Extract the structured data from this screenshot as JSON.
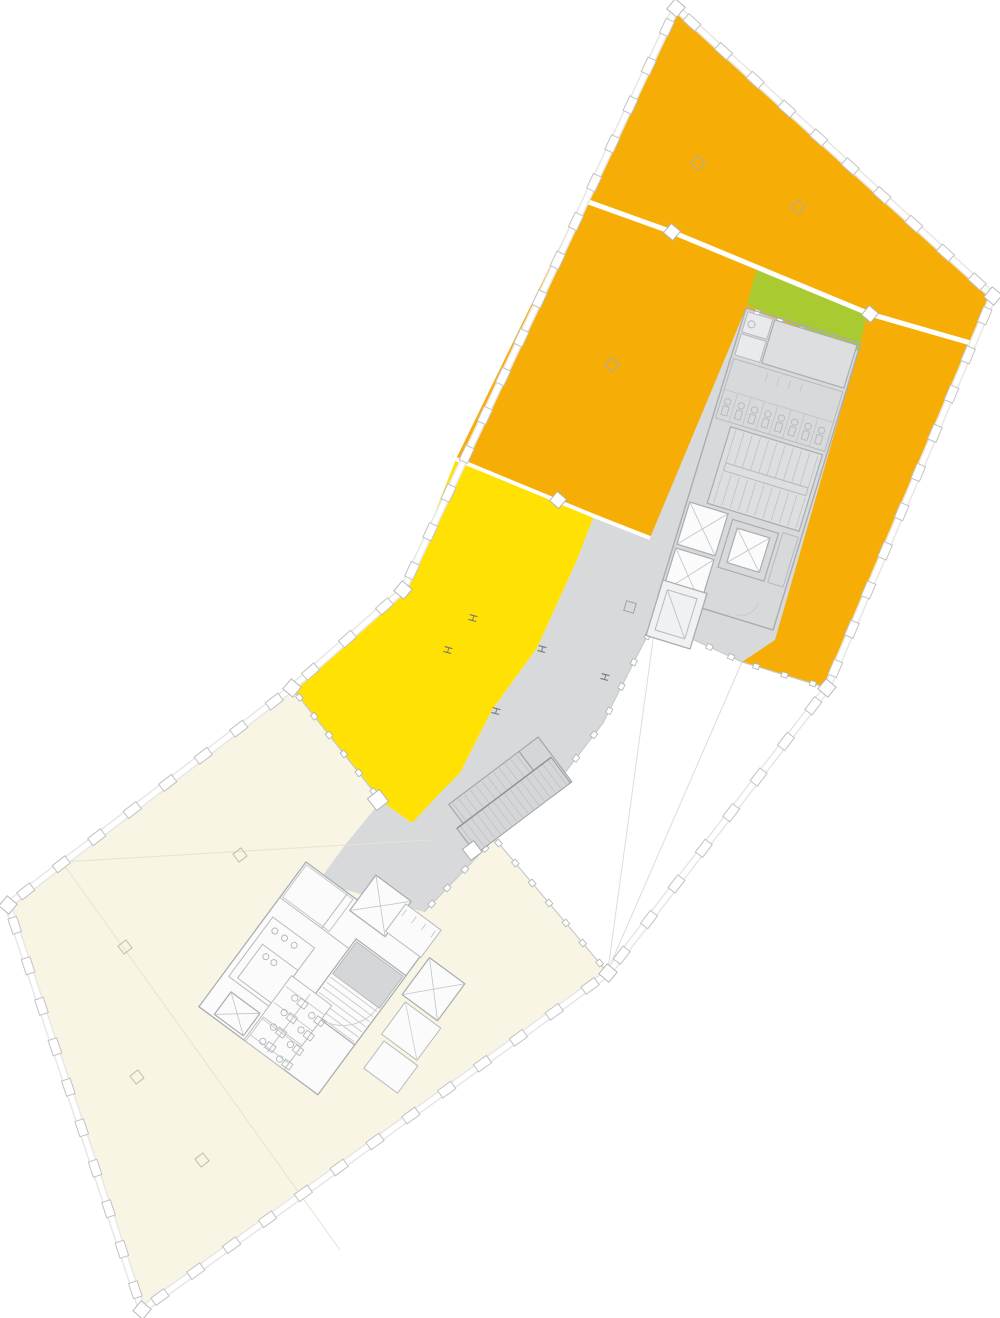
{
  "canvas": {
    "w": 1000,
    "h": 1318,
    "bg": "#ffffff"
  },
  "palette": {
    "orange": "#F6AE07",
    "yellow": "#FFE103",
    "green": "#AACA31",
    "gray": "#D8D9DB",
    "gray_dark": "#D2D4D6",
    "room": "#FBFBFB",
    "wall": "#A9ADB0",
    "wall_light": "#B7BABC",
    "detail": "#C3C6C8",
    "facade_stroke": "#C2C2C2",
    "facade_band": "#E7E7E7",
    "white": "#FFFFFF",
    "void_line": "#DCDCDC",
    "cream_line": "#E7E3D2",
    "cream": "#F8F5E4",
    "marker_gray": "#ABABAB",
    "marker_cream": "#C2BDA4",
    "h_color": "#787878"
  },
  "zones": [
    {
      "name": "zone-lower-cream-wing",
      "fill": "cream",
      "points": [
        [
          292,
          688
        ],
        [
          381,
          801
        ],
        [
          490,
          833
        ],
        [
          608,
          973
        ],
        [
          142,
          1310
        ],
        [
          8,
          905
        ]
      ]
    },
    {
      "name": "zone-upper-orange",
      "fill": "orange",
      "points": [
        [
          676,
          8
        ],
        [
          993,
          296
        ],
        [
          827,
          688
        ],
        [
          742,
          662
        ],
        [
          655,
          622
        ],
        [
          594,
          516
        ],
        [
          456,
          459
        ]
      ]
    },
    {
      "name": "zone-yellow",
      "fill": "yellow",
      "points": [
        [
          456,
          459
        ],
        [
          594,
          516
        ],
        [
          577,
          560
        ],
        [
          537,
          648
        ],
        [
          492,
          710
        ],
        [
          460,
          773
        ],
        [
          412,
          823
        ],
        [
          381,
          801
        ],
        [
          292,
          688
        ],
        [
          403,
          590
        ],
        [
          417,
          563
        ],
        [
          432,
          520
        ]
      ]
    },
    {
      "name": "zone-core-plaza-gray",
      "fill": "gray",
      "points": [
        [
          746,
          308
        ],
        [
          858,
          351
        ],
        [
          775,
          640
        ],
        [
          742,
          662
        ],
        [
          655,
          622
        ],
        [
          640,
          650
        ],
        [
          603,
          723
        ],
        [
          567,
          770
        ],
        [
          540,
          798
        ],
        [
          495,
          838
        ],
        [
          455,
          880
        ],
        [
          424,
          912
        ],
        [
          318,
          882
        ],
        [
          345,
          845
        ],
        [
          381,
          801
        ],
        [
          412,
          823
        ],
        [
          440,
          793
        ],
        [
          460,
          773
        ],
        [
          492,
          710
        ],
        [
          537,
          648
        ],
        [
          577,
          560
        ],
        [
          594,
          516
        ],
        [
          650,
          538
        ]
      ]
    },
    {
      "name": "zone-green",
      "fill": "green",
      "points": [
        [
          757,
          267
        ],
        [
          868,
          313
        ],
        [
          858,
          351
        ],
        [
          747,
          305
        ]
      ]
    }
  ],
  "faint_lines": [
    {
      "name": "void-sight-line-1",
      "points": [
        [
          655,
          625
        ],
        [
          608,
          970
        ]
      ],
      "color": "#DCDCDC"
    },
    {
      "name": "void-sight-line-2",
      "points": [
        [
          742,
          662
        ],
        [
          608,
          970
        ]
      ],
      "color": "#DCDCDC"
    },
    {
      "name": "void-sight-line-3",
      "points": [
        [
          827,
          690
        ],
        [
          610,
          968
        ]
      ],
      "color": "#E2E2E2"
    },
    {
      "name": "cream-partition-line-1",
      "points": [
        [
          62,
          862
        ],
        [
          340,
          1250
        ]
      ],
      "color": "#E7E3D2"
    },
    {
      "name": "cream-partition-line-2",
      "points": [
        [
          62,
          862
        ],
        [
          430,
          840
        ]
      ],
      "color": "#E7E3D2"
    }
  ],
  "facade": {
    "spacing": 44,
    "tick_w": 16,
    "tick_h": 9,
    "segments": [
      [
        [
          676,
          8
        ],
        [
          993,
          296
        ]
      ],
      [
        [
          993,
          296
        ],
        [
          827,
          688
        ]
      ],
      [
        [
          827,
          688
        ],
        [
          608,
          973
        ]
      ],
      [
        [
          608,
          973
        ],
        [
          142,
          1310
        ]
      ],
      [
        [
          142,
          1310
        ],
        [
          8,
          905
        ]
      ],
      [
        [
          8,
          905
        ],
        [
          292,
          688
        ]
      ],
      [
        [
          292,
          688
        ],
        [
          403,
          590
        ]
      ],
      [
        [
          403,
          590
        ],
        [
          676,
          8
        ]
      ]
    ],
    "corners": [
      [
        676,
        8
      ],
      [
        993,
        296
      ],
      [
        827,
        688
      ],
      [
        608,
        973
      ],
      [
        142,
        1310
      ],
      [
        8,
        905
      ],
      [
        292,
        688
      ],
      [
        403,
        590
      ]
    ]
  },
  "tick_lines": [
    {
      "name": "glass-yellow-cream",
      "points": [
        [
          292,
          688
        ],
        [
          381,
          801
        ]
      ]
    },
    {
      "name": "glass-plaza-void-a",
      "points": [
        [
          655,
          622
        ],
        [
          742,
          662
        ]
      ]
    },
    {
      "name": "glass-orange-void",
      "points": [
        [
          742,
          662
        ],
        [
          827,
          688
        ]
      ]
    },
    {
      "name": "glass-corridor-edge",
      "points": [
        [
          655,
          622
        ],
        [
          640,
          650
        ],
        [
          603,
          723
        ],
        [
          567,
          770
        ],
        [
          540,
          798
        ],
        [
          495,
          838
        ],
        [
          455,
          880
        ],
        [
          424,
          912
        ]
      ]
    },
    {
      "name": "glass-cream-void",
      "points": [
        [
          490,
          833
        ],
        [
          608,
          973
        ]
      ]
    },
    {
      "name": "glass-core-top",
      "points": [
        [
          746,
          308
        ],
        [
          858,
          351
        ]
      ]
    }
  ],
  "joints": {
    "lines": [
      {
        "name": "floor-joint-upper",
        "points": [
          [
            558,
            191
          ],
          [
            672,
            232
          ],
          [
            870,
            314
          ],
          [
            974,
            344
          ]
        ],
        "w": 5
      },
      {
        "name": "floor-joint-lower",
        "points": [
          [
            456,
            459
          ],
          [
            594,
            516
          ],
          [
            650,
            538
          ]
        ],
        "w": 4
      }
    ],
    "squares": [
      {
        "x": 672,
        "y": 232,
        "s": 12,
        "r": 40
      },
      {
        "x": 870,
        "y": 314,
        "s": 12,
        "r": 40
      },
      {
        "x": 558,
        "y": 500,
        "s": 12,
        "r": 40
      },
      {
        "x": 378,
        "y": 800,
        "s": 15,
        "r": 52
      }
    ]
  },
  "markers": {
    "h_glyph": "H",
    "h_columns": [
      [
        469,
        617
      ],
      [
        444,
        649
      ],
      [
        538,
        648
      ],
      [
        601,
        676
      ],
      [
        492,
        710
      ]
    ],
    "squares_orange": [
      [
        698,
        163
      ],
      [
        798,
        207
      ],
      [
        612,
        365
      ]
    ],
    "squares_plaza": [
      [
        630,
        607
      ]
    ],
    "diamonds_cream": [
      [
        240,
        855
      ],
      [
        125,
        947
      ],
      [
        137,
        1077
      ],
      [
        202,
        1160
      ]
    ]
  },
  "groups": [
    {
      "name": "upper-core",
      "transform": "translate(746,308) rotate(17)",
      "prims": [
        {
          "t": "rect",
          "x": 0,
          "y": 0,
          "w": 120,
          "h": 300,
          "s": "#A9ADB0",
          "sw": 1.4
        },
        {
          "t": "rect",
          "x": 3,
          "y": 3,
          "w": 26,
          "h": 21,
          "f": "#E9EAEB",
          "s": "#B7BABC"
        },
        {
          "t": "rect",
          "x": 3,
          "y": 26,
          "w": 26,
          "h": 22,
          "f": "#E9EAEB",
          "s": "#B7BABC"
        },
        {
          "t": "circle",
          "cx": 10,
          "cy": 14,
          "r": 3.5,
          "s": "#B7BABC"
        },
        {
          "t": "rect",
          "x": 31,
          "y": 3,
          "w": 86,
          "h": 45,
          "f": "#DCDEE0",
          "s": "#A9ADB0",
          "sw": 1.2
        },
        {
          "t": "rect",
          "x": 3,
          "y": 52,
          "w": 114,
          "h": 62,
          "s": "#B7BABC"
        },
        {
          "t": "line",
          "x1": 3,
          "y1": 84,
          "x2": 117,
          "y2": 84,
          "s": "#C3C6C8"
        },
        {
          "t": "grill",
          "x": 17,
          "y": 84,
          "w": 84,
          "h": 30,
          "n": 7,
          "o": "v"
        },
        {
          "t": "wcrow",
          "x": 10,
          "y": 95,
          "dx": 14,
          "n": 8
        },
        {
          "t": "grill",
          "x": 40,
          "y": 56,
          "w": 36,
          "h": 9,
          "n": 4,
          "o": "v"
        },
        {
          "t": "rect",
          "x": 20,
          "y": 118,
          "w": 96,
          "h": 80,
          "f": "#DCDEE0",
          "s": "#A9ADB0",
          "sw": 1.2
        },
        {
          "t": "grill",
          "x": 26,
          "y": 120,
          "w": 86,
          "h": 34,
          "n": 11,
          "o": "v"
        },
        {
          "t": "grill",
          "x": 26,
          "y": 164,
          "w": 86,
          "h": 32,
          "n": 11,
          "o": "v"
        },
        {
          "t": "rect",
          "x": 26,
          "y": 154,
          "w": 86,
          "h": 8,
          "s": "#B7BABC"
        },
        {
          "t": "xbox",
          "x": 3,
          "y": 202,
          "w": 40,
          "h": 44
        },
        {
          "t": "xbox",
          "x": 3,
          "y": 250,
          "w": 40,
          "h": 46
        },
        {
          "t": "rect",
          "x": 49,
          "y": 206,
          "w": 48,
          "h": 50,
          "s": "#A9ADB0",
          "sw": 1.2
        },
        {
          "t": "xbox",
          "x": 56,
          "y": 213,
          "w": 34,
          "h": 36
        },
        {
          "t": "rect",
          "x": 101,
          "y": 204,
          "w": 16,
          "h": 52,
          "s": "#B7BABC"
        },
        {
          "t": "arc",
          "d": "M 98 278 a 18 18 0 0 1 -18 18",
          "s": "#C9C9C9"
        }
      ]
    },
    {
      "name": "plaza-shaft",
      "transform": "translate(663,580) rotate(17)",
      "prims": [
        {
          "t": "rect",
          "x": 0,
          "y": 0,
          "w": 46,
          "h": 58,
          "f": "#F0F1F2",
          "s": "#A9ADB0",
          "sw": 1.3
        },
        {
          "t": "rect",
          "x": 7,
          "y": 8,
          "w": 31,
          "h": 42,
          "s": "#B7BABC"
        },
        {
          "t": "line",
          "x1": 7,
          "y1": 8,
          "x2": 38,
          "y2": 50,
          "s": "#C3C6C8"
        }
      ]
    },
    {
      "name": "corridor-stair",
      "transform": "translate(452,822) rotate(-37)",
      "prims": [
        {
          "t": "rect",
          "x": 96,
          "y": -16,
          "w": 24,
          "h": 56,
          "f": "#D4D6D8",
          "s": "#9AA0A4"
        },
        {
          "t": "rect",
          "x": 0,
          "y": 8,
          "w": 118,
          "h": 32,
          "f": "#D4D6D8",
          "s": "#9AA0A4"
        },
        {
          "t": "grill",
          "x": 4,
          "y": 8,
          "w": 110,
          "h": 32,
          "n": 17,
          "o": "v"
        },
        {
          "t": "rect",
          "x": 8,
          "y": -16,
          "w": 88,
          "h": 24,
          "f": "#D4D6D8",
          "s": "#9AA0A4"
        },
        {
          "t": "grill",
          "x": 12,
          "y": -16,
          "w": 80,
          "h": 24,
          "n": 12,
          "o": "v"
        },
        {
          "t": "line",
          "x1": 0,
          "y1": 8,
          "x2": 118,
          "y2": 8,
          "s": "#8D9296",
          "sw": 1.4
        },
        {
          "t": "rect",
          "x": -8,
          "y": 28,
          "w": 14,
          "h": 14,
          "f": "#FFFFFF",
          "s": "#A9ADB0"
        }
      ]
    },
    {
      "name": "lower-core",
      "transform": "translate(306,862) rotate(36.5)",
      "prims": [
        {
          "t": "rect",
          "x": 0,
          "y": 0,
          "w": 148,
          "h": 180,
          "f": "#FBFBFB",
          "s": "#A9ADB0",
          "sw": 1.3
        },
        {
          "t": "line",
          "x1": 0,
          "y1": 44,
          "x2": 148,
          "y2": 44,
          "s": "#B7BABC"
        },
        {
          "t": "line",
          "x1": 52,
          "y1": 0,
          "x2": 52,
          "y2": 44,
          "s": "#B7BABC"
        },
        {
          "t": "rect",
          "x": 2,
          "y": 2,
          "w": 58,
          "h": 40,
          "s": "#C3C6C8"
        },
        {
          "t": "xbox",
          "x": 64,
          "y": -31,
          "w": 44,
          "h": 44
        },
        {
          "t": "rect",
          "x": 6,
          "y": 64,
          "w": 52,
          "h": 74,
          "s": "#B7BABC"
        },
        {
          "t": "circle",
          "cx": 16,
          "cy": 74,
          "r": 3,
          "s": "#B7BABC"
        },
        {
          "t": "circle",
          "cx": 28,
          "cy": 74,
          "r": 3,
          "s": "#B7BABC"
        },
        {
          "t": "circle",
          "cx": 40,
          "cy": 74,
          "r": 3,
          "s": "#B7BABC"
        },
        {
          "t": "rect",
          "x": 86,
          "y": 32,
          "w": 62,
          "h": 86,
          "f": "#FBFBFB",
          "s": "#A9ADB0",
          "sw": 1.2
        },
        {
          "t": "rect",
          "x": 88,
          "y": 34,
          "w": 58,
          "h": 40,
          "f": "#D4D6D8"
        },
        {
          "t": "grill",
          "x": 88,
          "y": 78,
          "w": 58,
          "h": 38,
          "n": 7,
          "o": "h"
        },
        {
          "t": "arc",
          "d": "M 90 116 a 42 42 0 0 0 54 -42",
          "s": "#D0D0D0"
        },
        {
          "t": "rect",
          "x": 14,
          "y": 92,
          "w": 44,
          "h": 42,
          "s": "#B7BABC"
        },
        {
          "t": "circle",
          "cx": 24,
          "cy": 100,
          "r": 3,
          "s": "#B7BABC"
        },
        {
          "t": "circle",
          "cx": 34,
          "cy": 100,
          "r": 3,
          "s": "#B7BABC"
        },
        {
          "t": "rect",
          "x": 56,
          "y": 100,
          "w": 50,
          "h": 80,
          "f": "#FBFBFB",
          "s": "#B7BABC"
        },
        {
          "t": "line",
          "x1": 82,
          "y1": 104,
          "x2": 82,
          "y2": 176,
          "s": "#C3C6C8"
        },
        {
          "t": "grill",
          "x": 58,
          "y": 112,
          "w": 24,
          "h": 60,
          "n": 4,
          "o": "h"
        },
        {
          "t": "grill",
          "x": 82,
          "y": 112,
          "w": 24,
          "h": 60,
          "n": 4,
          "o": "h"
        },
        {
          "t": "wccol",
          "x": 72,
          "y": 116,
          "dy": 18,
          "n": 4
        },
        {
          "t": "wccol",
          "x": 96,
          "y": 120,
          "dy": 18,
          "n": 4
        },
        {
          "t": "xbox",
          "x": 17,
          "y": 149,
          "w": 36,
          "h": 28
        },
        {
          "t": "rect",
          "x": 58,
          "y": 150,
          "w": 48,
          "h": 30,
          "s": "#C3C6C8"
        }
      ]
    },
    {
      "name": "lower-core-east-wing",
      "transform": "translate(400,942) rotate(36.5)",
      "prims": [
        {
          "t": "rect",
          "x": -18,
          "y": -34,
          "w": 44,
          "h": 34,
          "f": "#FBFBFB",
          "s": "#B7BABC"
        },
        {
          "t": "grill",
          "x": -14,
          "y": -30,
          "w": 36,
          "h": 8,
          "n": 4,
          "o": "v"
        },
        {
          "t": "xbox",
          "x": 33,
          "y": -5,
          "w": 44,
          "h": 46
        },
        {
          "t": "rect",
          "x": 40,
          "y": 45,
          "w": 44,
          "h": 40,
          "f": "#FBFBFB",
          "s": "#B7BABC"
        },
        {
          "t": "line",
          "x1": 40,
          "y1": 45,
          "x2": 84,
          "y2": 85,
          "s": "#D5D5D5"
        },
        {
          "t": "rect",
          "x": 46,
          "y": 89,
          "w": 42,
          "h": 34,
          "f": "#FBFBFB",
          "s": "#B7BABC"
        }
      ]
    }
  ]
}
